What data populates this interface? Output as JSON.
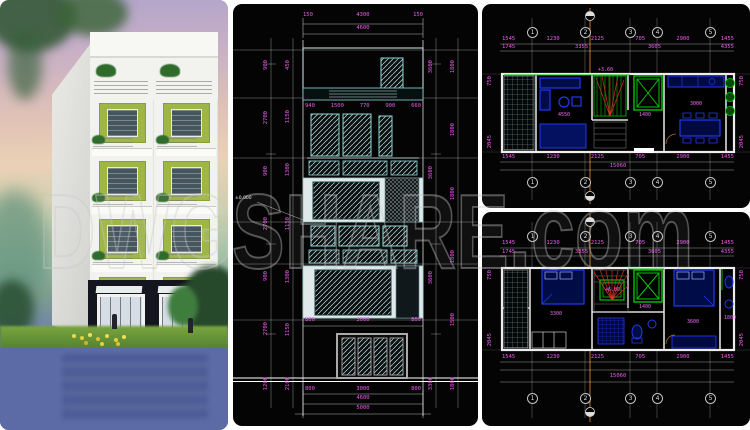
{
  "watermark": {
    "text": "DWGSHARE.com"
  },
  "colors": {
    "dimension_magenta": "#ee5cee",
    "cad_cyan": "#8fd8d8",
    "cad_green": "#00c400",
    "furniture_blue": "#2238f0",
    "section_line_orange": "#b87433",
    "facade_green": "#9fb647"
  },
  "elevation": {
    "dims_top": [
      "150",
      "4300",
      "150"
    ],
    "dims_top_total": [
      "4600"
    ],
    "dims_window": [
      "940",
      "1500",
      "770",
      "900",
      "660"
    ],
    "dims_mid": [
      "800",
      "3000",
      "800"
    ],
    "dims_door": [
      "800",
      "3000",
      "800"
    ],
    "dims_total_1": [
      "4600"
    ],
    "dims_total_2": [
      "5000"
    ],
    "left_outer": [
      "900",
      "2700",
      "900",
      "2700",
      "900",
      "2700",
      "1200"
    ],
    "left_inner": [
      "450",
      "1150",
      "1300",
      "1150",
      "1300",
      "1150",
      "2100"
    ],
    "right_inner": [
      "3600",
      "3600",
      "3600",
      "3300"
    ],
    "right_outer": [
      "1800",
      "1800",
      "1800",
      "1800",
      "1500",
      "1800"
    ],
    "level_note": "±0.000"
  },
  "plan_top": {
    "grid_labels": [
      "1",
      "2",
      "3",
      "4",
      "5"
    ],
    "dims_row1": [
      "1545",
      "1230",
      "2125",
      "705",
      "2900",
      "1455"
    ],
    "dims_row2": [
      "1745",
      "3355",
      "3605",
      "4355"
    ],
    "dims_row3": [
      "1545",
      "1230",
      "2125",
      "705",
      "2900",
      "1455"
    ],
    "dims_total": [
      "15060"
    ],
    "side_dims_left": [
      "750",
      "2045"
    ],
    "side_dims_right": [
      "750",
      "2045"
    ],
    "tag_living": "4550",
    "tag_stair": "+3.60",
    "tag_lift": "1400",
    "tag_dining": "3000"
  },
  "plan_bottom": {
    "grid_labels": [
      "1",
      "2",
      "3",
      "4",
      "5"
    ],
    "dims_row1": [
      "1545",
      "1230",
      "2125",
      "705",
      "2900",
      "1455"
    ],
    "dims_row2": [
      "1745",
      "3355",
      "3605",
      "4355"
    ],
    "dims_row3": [
      "1545",
      "1230",
      "2125",
      "705",
      "2900",
      "1455"
    ],
    "dims_total": [
      "15060"
    ],
    "side_dims_left": [
      "750",
      "2045"
    ],
    "side_dims_right": [
      "750",
      "2045"
    ],
    "tag_bed1": "3300",
    "tag_stair": "+6.80",
    "tag_lift": "1400",
    "tag_bed2": "3600",
    "tag_bath": "1800"
  }
}
